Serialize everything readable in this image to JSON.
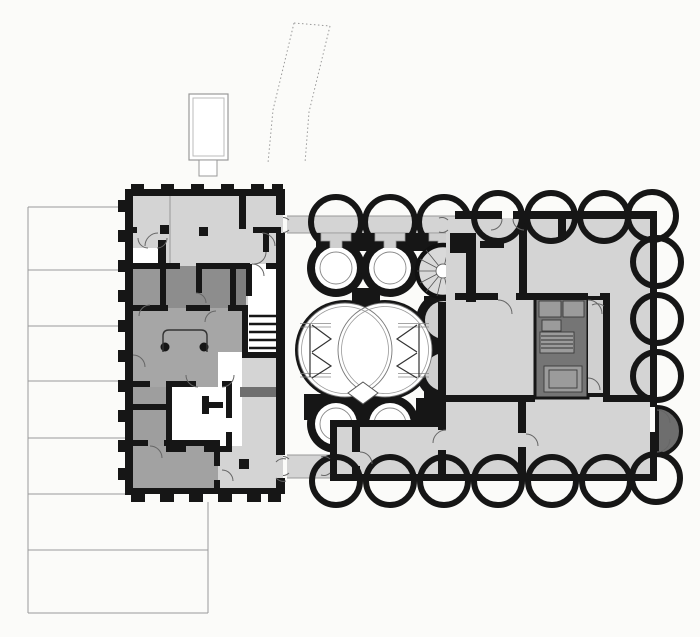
{
  "document": {
    "kind": "architectural-floor-plan",
    "visible_text": ""
  },
  "palette": {
    "background": "#fbfbf9",
    "floor_light": "#d4d4d4",
    "floor_medium": "#a6a6a6",
    "room_dark_a": "#8d8d8d",
    "room_dark_b": "#7f7f7f",
    "room_left_light": "#989898",
    "room_lower_left": "#9e9e9e",
    "band_lower": "#a2a2a2",
    "core_dark": "#757575",
    "niche_dark": "#6e6e6e",
    "dark_bar": "#6f6f6f",
    "equipment": "#9b9b9b",
    "spiral_fill": "#d9d9d9",
    "wall": "#161616",
    "thin_line": "#999999",
    "white": "#ffffff"
  },
  "elements": {
    "site": [
      "terrace-steps",
      "skylight-structure",
      "dotted-footpath"
    ],
    "connectors": [
      "upper-corridor-bridge",
      "lower-corridor-bridge"
    ],
    "left_building": [
      "north-hall",
      "anteroom",
      "dark-room-cluster",
      "stair-run-east",
      "reception-desk",
      "columns",
      "white-core-room",
      "south-rooms",
      "dashed-entrance-wall"
    ],
    "right_building": [
      "scalloped-perimeter",
      "keyhole-round-rooms",
      "spiral-staircase",
      "quatrefoil-hall",
      "stage-glyphs",
      "diamond-motif",
      "entry-hall",
      "great-room",
      "service-core",
      "core-stair",
      "east-niche-dark",
      "south-wing"
    ]
  }
}
